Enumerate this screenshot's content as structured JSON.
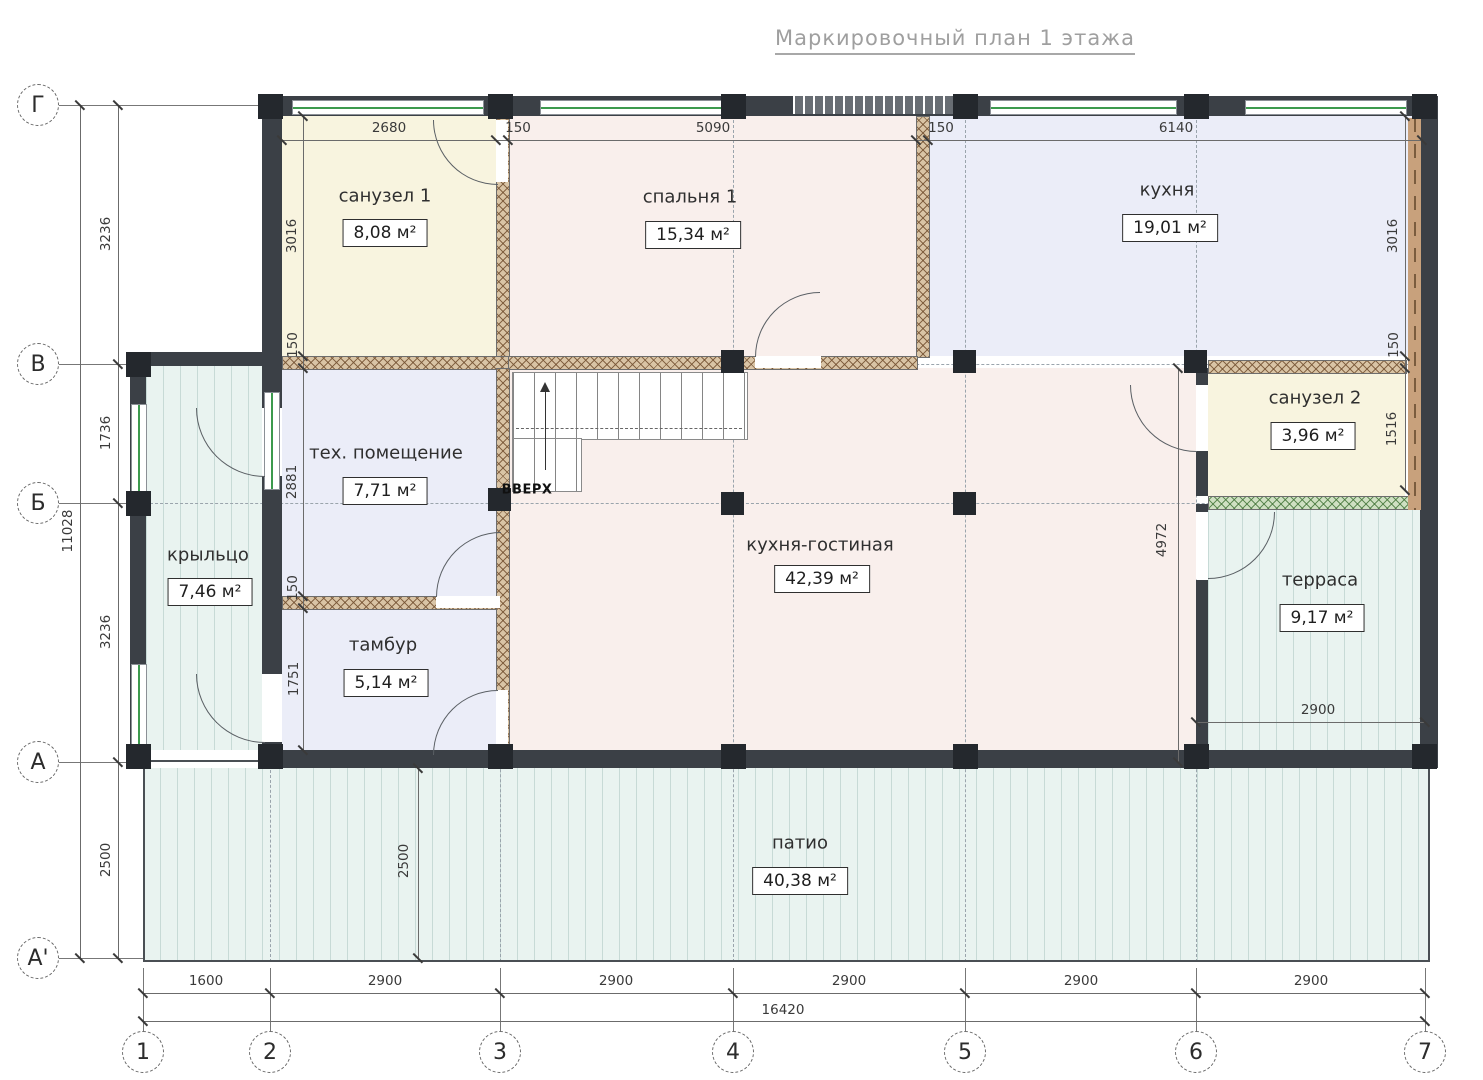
{
  "title": "Маркировочный план 1 этажа",
  "axes": {
    "rows": [
      "Г",
      "В",
      "Б",
      "А",
      "А'"
    ],
    "cols": [
      "1",
      "2",
      "3",
      "4",
      "5",
      "6",
      "7"
    ]
  },
  "rooms": [
    {
      "name": "санузел 1",
      "area": "8,08 м²"
    },
    {
      "name": "спальня 1",
      "area": "15,34 м²"
    },
    {
      "name": "кухня",
      "area": "19,01 м²"
    },
    {
      "name": "тех. помещение",
      "area": "7,71 м²"
    },
    {
      "name": "санузел 2",
      "area": "3,96 м²"
    },
    {
      "name": "крыльцо",
      "area": "7,46 м²"
    },
    {
      "name": "кухня-гостиная",
      "area": "42,39 м²"
    },
    {
      "name": "тамбур",
      "area": "5,14 м²"
    },
    {
      "name": "терраса",
      "area": "9,17 м²"
    },
    {
      "name": "патио",
      "area": "40,38 м²"
    }
  ],
  "stairs": {
    "label": "ВВЕРХ"
  },
  "dims": {
    "top": [
      "2680",
      "150",
      "5090",
      "150",
      "6140"
    ],
    "bottom": [
      "1600",
      "2900",
      "2900",
      "2900",
      "2900",
      "2900"
    ],
    "bottom_total": "16420",
    "left": [
      "3236",
      "1736",
      "3236",
      "2500"
    ],
    "left_total": "11028",
    "inner": [
      "3016",
      "150",
      "2881",
      "150",
      "1751",
      "2500",
      "3016",
      "150",
      "1516",
      "4972",
      "2900"
    ]
  },
  "colors": {
    "wall": "#3b4046",
    "window_glass": "#3d9a4e",
    "partition_hatch": "#765434",
    "deck": "#e9f3f0",
    "wet_room": "#f8f4df",
    "living_room": "#f9efec",
    "service_room": "#ebedf8",
    "dimension_text": "#3a3a3a",
    "title_text": "#9f9f9f"
  }
}
